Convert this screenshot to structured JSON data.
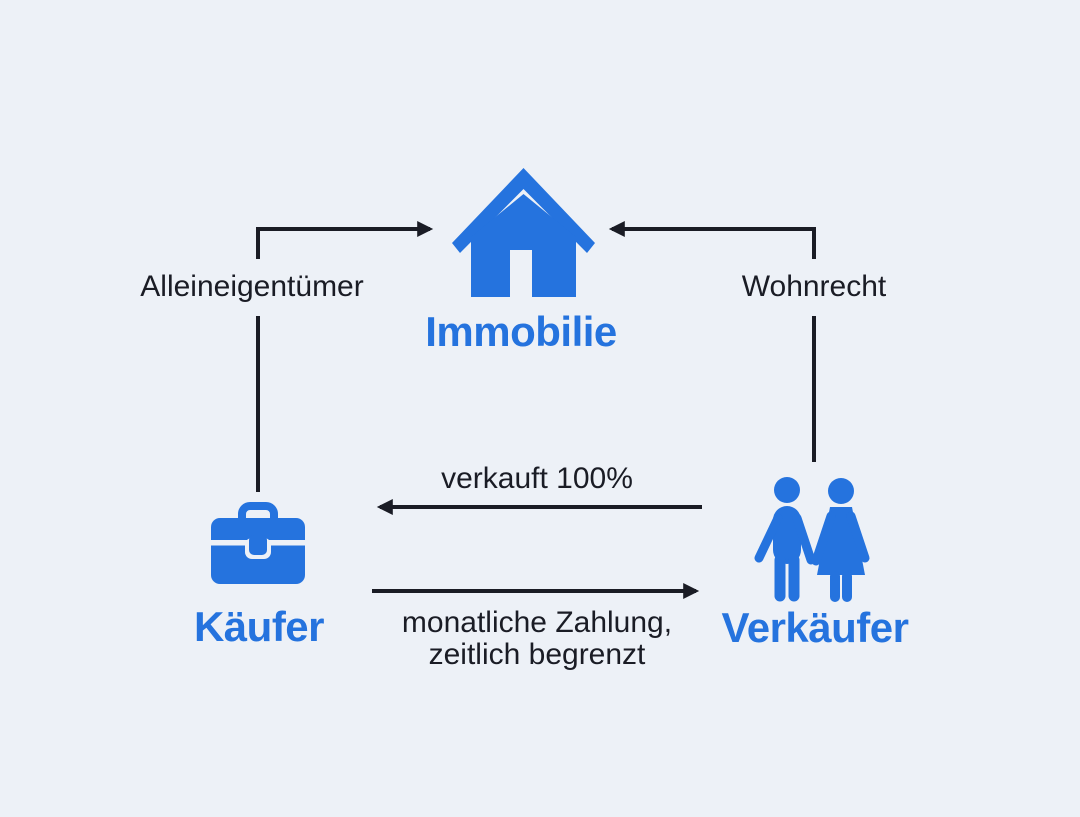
{
  "diagram": {
    "background_color": "#edf1f7",
    "accent_blue": "#2573de",
    "line_color": "#1a1c25",
    "nodes": {
      "property": {
        "label": "Immobilie",
        "icon": "house-icon"
      },
      "buyer": {
        "label": "Käufer",
        "icon": "briefcase-icon"
      },
      "seller": {
        "label": "Verkäufer",
        "icon": "couple-icon"
      }
    },
    "edges": {
      "buyer_property": {
        "label": "Alleineigentümer",
        "from": "buyer",
        "to": "property"
      },
      "seller_property": {
        "label": "Wohnrecht",
        "from": "seller",
        "to": "property"
      },
      "seller_buyer": {
        "label": "verkauft 100%",
        "from": "seller",
        "to": "buyer"
      },
      "buyer_seller": {
        "label_line1": "monatliche Zahlung,",
        "label_line2": "zeitlich begrenzt",
        "from": "buyer",
        "to": "seller"
      }
    }
  }
}
